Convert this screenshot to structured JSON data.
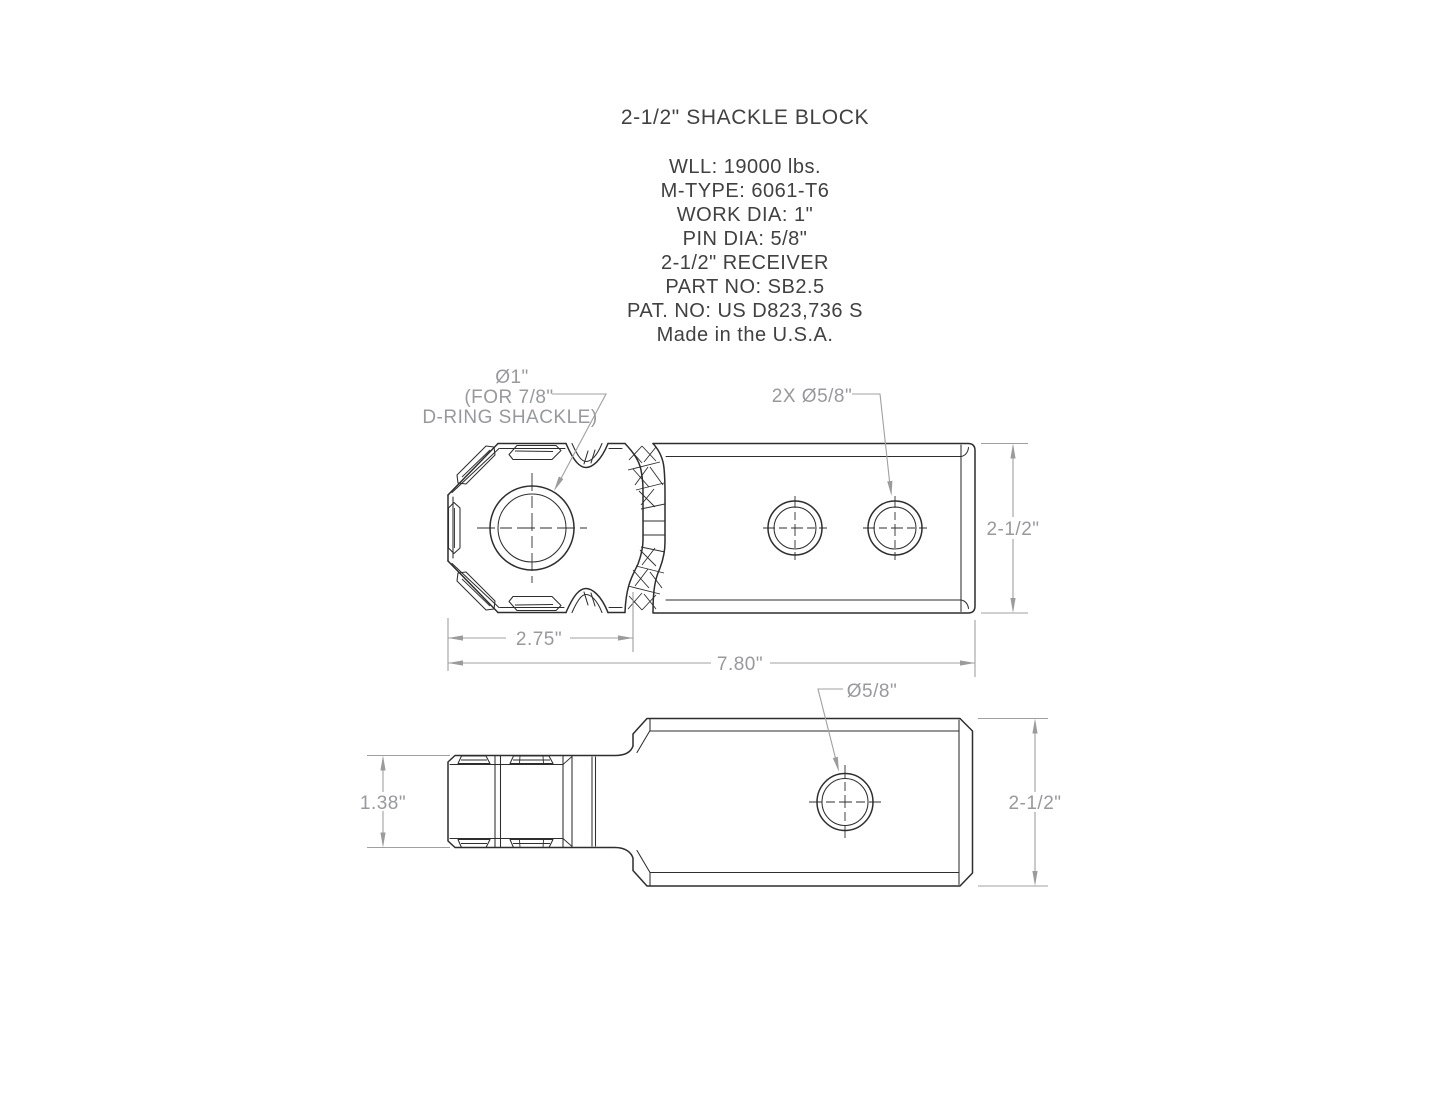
{
  "title": "2-1/2\" SHACKLE BLOCK",
  "specs": {
    "wll": "WLL: 19000 lbs.",
    "material": "M-TYPE: 6061-T6",
    "work_dia": "WORK DIA: 1\"",
    "pin_dia": "PIN DIA: 5/8\"",
    "receiver": "2-1/2\" RECEIVER",
    "part_no": "PART NO: SB2.5",
    "patent_no": "PAT. NO: US D823,736 S",
    "origin": "Made in the U.S.A."
  },
  "top_view": {
    "shackle_hole_label_1": "Ø1\"",
    "shackle_hole_label_2": "(FOR 7/8\"",
    "shackle_hole_label_3": "D-RING SHACKLE)",
    "pin_holes_label": "2X Ø5/8\"",
    "dim_height": "2-1/2\"",
    "dim_head_length": "2.75\"",
    "dim_total_length": "7.80\""
  },
  "side_view": {
    "pin_hole_label": "Ø5/8\"",
    "dim_tongue_height": "1.38\"",
    "dim_block_height": "2-1/2\""
  },
  "colors": {
    "part_line": "#2f2d2e",
    "dimension_line": "#a0a0a2",
    "dimension_text": "#97999c",
    "spec_text": "#414042",
    "background": "#ffffff"
  }
}
